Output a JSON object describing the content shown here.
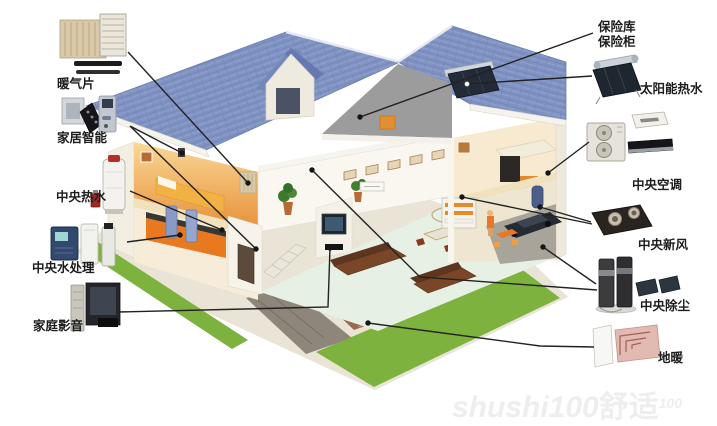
{
  "title": "home-systems-cutaway-diagram",
  "callouts": {
    "radiator": {
      "label": "暖气片"
    },
    "smart_home": {
      "label": "家居智能"
    },
    "central_hot_water": {
      "label": "中央热水"
    },
    "central_water_treatment": {
      "label": "中央水处理"
    },
    "home_av": {
      "label": "家庭影音"
    },
    "vault_line1": {
      "label": "保险库"
    },
    "vault_line2": {
      "label": "保险柜"
    },
    "solar_hot_water": {
      "label": "太阳能热水"
    },
    "central_ac": {
      "label": "中央空调"
    },
    "central_fresh_air": {
      "label": "中央新风"
    },
    "central_vacuum": {
      "label": "中央除尘"
    },
    "floor_heating": {
      "label": "地暖"
    }
  },
  "watermark": {
    "part1": "shushi100",
    "part2": "舒适",
    "part3": "100"
  },
  "icons": {
    "left": [
      "radiator-thumbnail",
      "smart-home-thumbnail",
      "water-heater-thumbnail",
      "water-treatment-thumbnail",
      "home-av-thumbnail"
    ],
    "right": [
      "solar-heater-thumbnail",
      "ac-units-thumbnail",
      "fresh-air-unit-thumbnail",
      "central-vacuum-thumbnail",
      "floor-heating-thumbnail"
    ]
  },
  "colors": {
    "roof_tile": "#8093c3",
    "roof_tile_dark": "#6b7eae",
    "lawn": "#7cb23d",
    "warm_wall": "#e8913a",
    "kitchen_orange": "#e8791f",
    "callout_line": "#222222",
    "gable_gray": "#9c9c9c",
    "solar_panel": "#232a38"
  }
}
